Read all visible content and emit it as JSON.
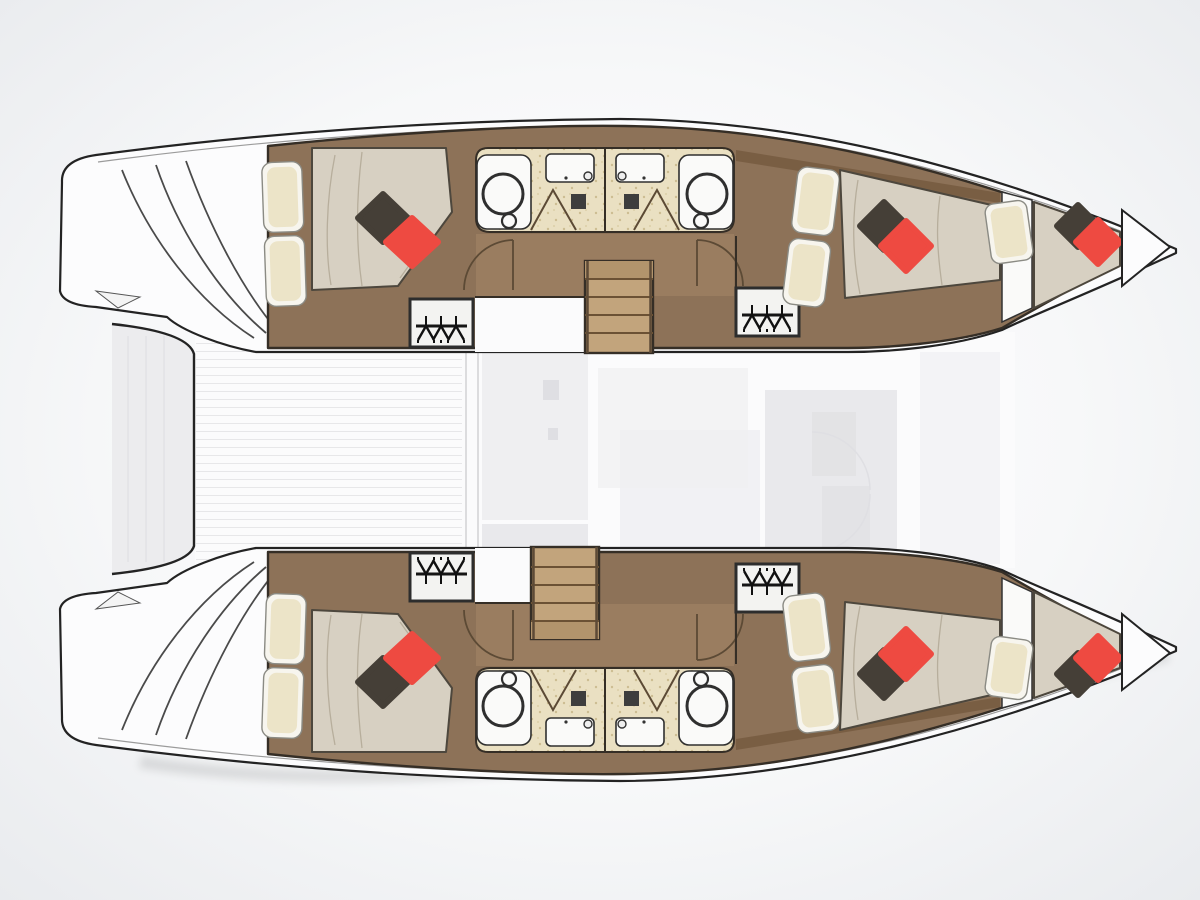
{
  "image": {
    "type": "floor-plan-diagram",
    "subject": "Catamaran sailing yacht interior deck plan, top-down view",
    "notes": "No visible text labels in the image; purely graphical boat layout drawing"
  },
  "vessel": {
    "kind": "catamaran",
    "hulls": 2,
    "orientation": "bow to the right, stern (transom steps) to the left",
    "aria_label": "Top-down floor plan of a catamaran with four double cabins, four bathrooms, two bow berths, central saloon and aft cockpit"
  },
  "rooms": [
    "aft-cabin-port",
    "bathroom-port-aft",
    "bathroom-port-forward",
    "forward-cabin-port",
    "bow-berth-port",
    "aft-cabin-starboard",
    "bathroom-starboard-aft",
    "bathroom-starboard-forward",
    "forward-cabin-starboard",
    "bow-berth-starboard",
    "saloon-bridgedeck",
    "aft-cockpit",
    "aft-platform",
    "transom-steps"
  ],
  "features": {
    "double_beds": 4,
    "bow_berths": 2,
    "bathrooms": 4,
    "toilets": 4,
    "sinks": 4,
    "shower_doors": 4,
    "wardrobes": 4,
    "staircases": 2,
    "red_accent_pillows": 6,
    "dark_accent_pillows": 6
  },
  "icons": [
    "wardrobe-hangers-icon",
    "toilet-icon",
    "sink-icon",
    "shower-door-icon",
    "stairs-icon",
    "door-swing-arc-icon",
    "bed-pillow-icon"
  ],
  "colors": {
    "bg_outer": "#e9ebee",
    "hull_white": "#fcfcfd",
    "saloon_white": "#fbfbfc",
    "outline": "#232323",
    "outline_dark": "#352e26",
    "wood_main": "#8d7258",
    "wood_dark": "#74593f",
    "wood_light": "#9a7d60",
    "stair_wood": "#c2a47c",
    "bath_floor": "#eae0c2",
    "bath_speckle": "#cdbd92",
    "fixture_white": "#fafaf9",
    "duvet": "#d7d0c2",
    "wrinkle": "#b7ae9c",
    "pillow_cream": "#ece4c8",
    "pillow_case": "#f7f5ee",
    "pillow_dark": "#453f37",
    "pillow_red": "#ee4a41",
    "ghost_1": "#efeff1",
    "ghost_2": "#e9e9ec",
    "ghost_3": "#dfdfe3",
    "door_line": "#5c4a35",
    "platform_fill": "#ececee"
  }
}
